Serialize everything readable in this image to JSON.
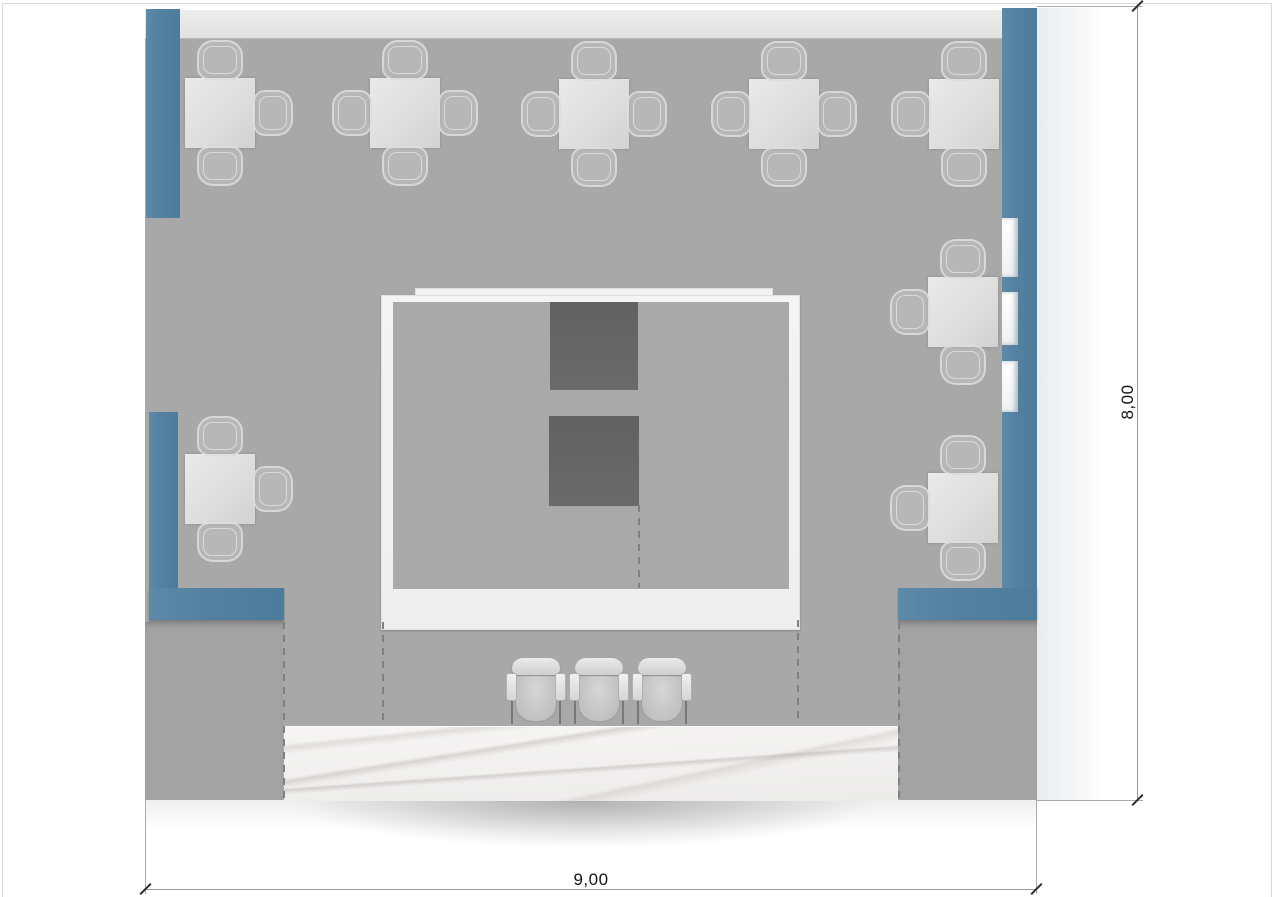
{
  "drawing": {
    "type": "floor-plan-top-view",
    "room_width_label": "9,00",
    "room_height_label": "8,00"
  },
  "colors": {
    "accent_blue": "#53819f",
    "floor_gray": "#a8a8a8",
    "wall_band": "#e8e8e8",
    "island_white": "#f3f3f3",
    "equipment_dark": "#656565",
    "marble_base": "#f4f3f2",
    "dimension_line": "#9a9a9a",
    "dimension_text": "#141414"
  },
  "furniture": {
    "dining_sets": [
      {
        "x": 40,
        "y": 70,
        "seats": [
          "top",
          "right",
          "bottom"
        ]
      },
      {
        "x": 225,
        "y": 70,
        "seats": [
          "top",
          "right",
          "bottom",
          "left"
        ]
      },
      {
        "x": 414,
        "y": 71,
        "seats": [
          "top",
          "right",
          "bottom",
          "left"
        ]
      },
      {
        "x": 604,
        "y": 71,
        "seats": [
          "top",
          "right",
          "bottom",
          "left"
        ]
      },
      {
        "x": 784,
        "y": 71,
        "seats": [
          "top",
          "bottom",
          "left"
        ]
      },
      {
        "x": 40,
        "y": 446,
        "seats": [
          "top",
          "right",
          "bottom"
        ]
      },
      {
        "x": 783,
        "y": 269,
        "seats": [
          "top",
          "bottom",
          "left"
        ]
      },
      {
        "x": 783,
        "y": 465,
        "seats": [
          "top",
          "bottom",
          "left"
        ]
      }
    ],
    "bar_chairs": [
      {
        "x": 362,
        "y": 650
      },
      {
        "x": 425,
        "y": 650
      },
      {
        "x": 488,
        "y": 650
      }
    ],
    "shelf_compartments": [
      {
        "y": 210,
        "h": 59
      },
      {
        "y": 284,
        "h": 53
      },
      {
        "y": 353,
        "h": 51
      }
    ],
    "island_dark_units": [
      {
        "x": 168,
        "y": 6,
        "w": 88,
        "h": 88
      },
      {
        "x": 167,
        "y": 120,
        "w": 90,
        "h": 90
      }
    ],
    "dash_lines": [
      {
        "x": 138,
        "y": 614,
        "h": 178
      },
      {
        "x": 237,
        "y": 614,
        "h": 101
      },
      {
        "x": 652,
        "y": 612,
        "h": 103
      },
      {
        "x": 753,
        "y": 614,
        "h": 178
      },
      {
        "x": 493,
        "y": 497,
        "h": 83
      }
    ]
  }
}
